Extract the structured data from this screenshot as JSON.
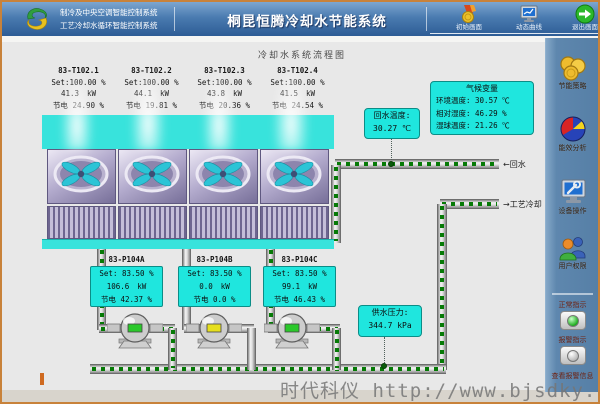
{
  "header": {
    "sys_line1": "制冷及中央空调智能控制系统",
    "sys_line2": "工艺冷却水循环智能控制系统",
    "title": "桐昆恒腾冷却水节能系统",
    "nav": [
      {
        "label": "初始画面",
        "icon": "medal-icon"
      },
      {
        "label": "动态曲线",
        "icon": "monitor-curve-icon"
      },
      {
        "label": "退出画面",
        "icon": "exit-arrow-icon"
      }
    ]
  },
  "diagram": {
    "title": "冷却水系统流程图",
    "towers": [
      {
        "id": "83-T102.1",
        "set": "Set:100.00 %",
        "power": "41.3",
        "unit": "kW",
        "save_label": "节电",
        "save": "24.90 %"
      },
      {
        "id": "83-T102.2",
        "set": "Set:100.00 %",
        "power": "44.1",
        "unit": "kW",
        "save_label": "节电",
        "save": "19.81 %"
      },
      {
        "id": "83-T102.3",
        "set": "Set:100.00 %",
        "power": "43.8",
        "unit": "kW",
        "save_label": "节电",
        "save": "20.36 %"
      },
      {
        "id": "83-T102.4",
        "set": "Set:100.00 %",
        "power": "41.5",
        "unit": "kW",
        "save_label": "节电",
        "save": "24.54 %"
      }
    ],
    "pumps": [
      {
        "id": "83-P104A",
        "set": "Set: 83.50 %",
        "power": "106.6",
        "unit": "kW",
        "save_label": "节电",
        "save": "42.37 %",
        "status": "running"
      },
      {
        "id": "83-P104B",
        "set": "Set: 83.50 %",
        "power": "0.0",
        "unit": "kW",
        "save_label": "节电",
        "save": "0.0 %",
        "status": "stopped"
      },
      {
        "id": "83-P104C",
        "set": "Set: 83.50 %",
        "power": "99.1",
        "unit": "kW",
        "save_label": "节电",
        "save": "46.43 %",
        "status": "running"
      }
    ],
    "return_temp": {
      "label": "回水温度:",
      "value": "30.27 ℃"
    },
    "climate": {
      "title": "气候变量",
      "rows": [
        {
          "text": "环境温度: 30.57 ℃"
        },
        {
          "text": "相对湿度: 46.29 %"
        },
        {
          "text": "湿球温度: 21.26 ℃"
        }
      ]
    },
    "supply_pressure": {
      "label": "供水压力:",
      "value": "344.7 kPa"
    },
    "labels": {
      "return_water": "←回水",
      "process_cooling": "→工艺冷却"
    }
  },
  "sidebar": {
    "items": [
      {
        "label": "节能策略",
        "icon": "coins-icon"
      },
      {
        "label": "能效分析",
        "icon": "pie-chart-icon"
      },
      {
        "label": "设备操作",
        "icon": "monitor-wrench-icon"
      },
      {
        "label": "用户权限",
        "icon": "users-icon"
      }
    ],
    "normal_label": "正常指示",
    "alarm_label": "报警指示",
    "view_alarm_label": "查看报警信息"
  },
  "watermark": "时代科仪 http://www.bjsdky.com.cn",
  "colors": {
    "frame_orange": "#c8823a",
    "header_blue": "#4a7bb0",
    "sidebar_blue": "#5e87ae",
    "cyan_panel": "#1fe6de",
    "flow_green": "#067a06",
    "run_green": "#2bc82b",
    "stop_yellow": "#e6df1e"
  }
}
